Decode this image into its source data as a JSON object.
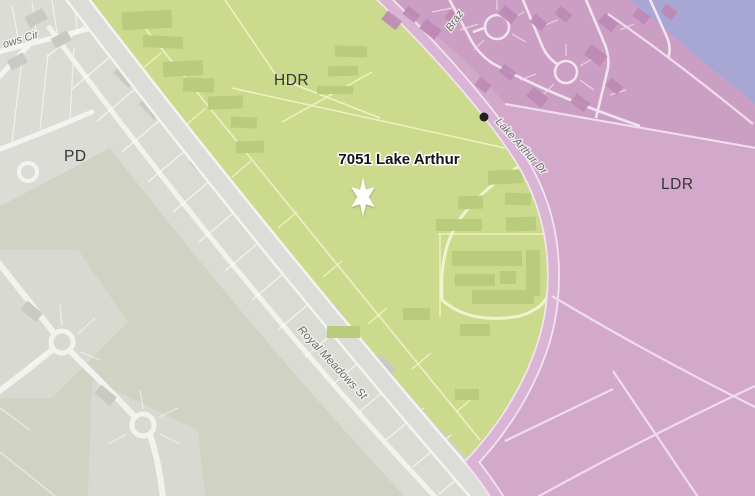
{
  "map": {
    "kind": "land-use-zoning-map",
    "marker": {
      "label": "7051 Lake Arthur",
      "symbol": "six-pointed-star",
      "color": "#ffffff"
    },
    "zone_labels": {
      "pd": "PD",
      "hdr": "HDR",
      "ldr": "LDR"
    },
    "street_labels": {
      "meadows_cir": "ows Cir",
      "brazos": "Braz",
      "lake_arthur_dr": "Lake Arthur Dr",
      "royal_meadows_st": "Royal Meadows St"
    },
    "colors": {
      "hdr_zone": "#cbda8d",
      "ldr_zone": "#d2a9ca",
      "pd_area": "#dbdcd5",
      "open_land": "#d0d3c4",
      "water": "#a8a6d2",
      "road_gray": "#dcdcd8",
      "road_white": "#f4f4f1",
      "lake_arthur_dr_road": "#d9b4d4",
      "building_green": "#b9cb7c",
      "building_pink": "#bd89b5",
      "poi_dot": "#222222"
    }
  }
}
